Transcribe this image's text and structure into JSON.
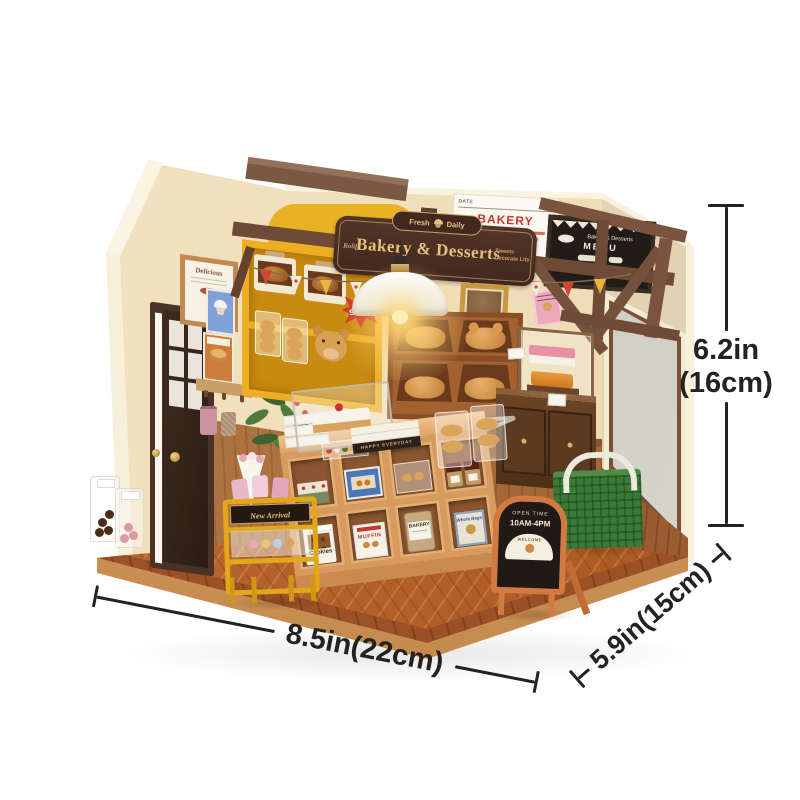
{
  "photo": {
    "dimensions": {
      "height_in": "6.2in",
      "height_cm": "(16cm)",
      "width": "8.5in(22cm)",
      "depth": "5.9in(15cm)"
    },
    "hanging_sign": {
      "brand": "Rolife",
      "title": "Bakery & Desserts",
      "badge_left": "Fresh",
      "badge_right": "Daily",
      "tagline_line1": "Sweets",
      "tagline_line2": "Decorate Life"
    },
    "menu_board": {
      "title": "Bakery & Desserts",
      "subtitle": "MENU"
    },
    "price_list": {
      "header_left": "DATE",
      "header_right": "NO.1",
      "title": "BAKERY"
    },
    "wall_frame": {
      "caption": "Delicious"
    },
    "sale_badge": {
      "label": "SALE!"
    },
    "cart_sign": {
      "label": "New Arrival"
    },
    "open_sign": {
      "line1": "OPEN TIME",
      "line2": "10AM-4PM",
      "banner": "WELCOME"
    },
    "counter": {
      "happy_sign": "HAPPY EVERYDAY",
      "cookies_bag": "Cookies",
      "muffin_box": "MUFFIN",
      "bakery_jar": "BAKERY",
      "tin": "Whole Bags"
    },
    "palette": {
      "background": "#ffffff",
      "wall_cream": "#f1e0bd",
      "wood_floor": "#b4612e",
      "base_tan": "#d8a265",
      "beam_brown": "#6f4b37",
      "sign_brown": "#4a3129",
      "sign_gold": "#e7c27d",
      "cabinet_yellow": "#eaa41e",
      "counter_wood": "#d89a5f",
      "chalkboard_black": "#211c17",
      "open_sign_orange": "#d37a42",
      "basket_green": "#3c7a38",
      "dimension_ink": "#222222"
    }
  }
}
